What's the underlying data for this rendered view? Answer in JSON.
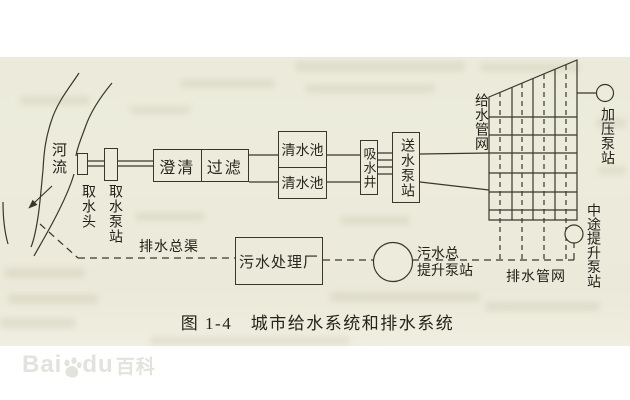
{
  "page": {
    "caption": "图 1-4　城市给水系统和排水系统",
    "watermark": {
      "part1": "Bai",
      "part2": "du",
      "part3": "百科"
    }
  },
  "nodes": {
    "river": "河流",
    "intake_head": "取水头",
    "intake_pump_station": "取水泵站",
    "clarifier": "澄清",
    "filter": "过滤",
    "clear_water_tank_top": "清水池",
    "clear_water_tank_bottom": "清水池",
    "suction_well": "吸水井",
    "delivery_pump_station": "送水泵站",
    "water_supply_network": "给水管网",
    "booster_pump_station": "加压泵站",
    "midway_lift_pump_station": "中途提升泵站",
    "main_drainage_channel": "排水总渠",
    "sewage_treatment_plant": "污水处理厂",
    "sewage_main_lift_station_line1": "污水总",
    "sewage_main_lift_station_line2": "提升泵站",
    "drainage_network": "排水管网"
  }
}
